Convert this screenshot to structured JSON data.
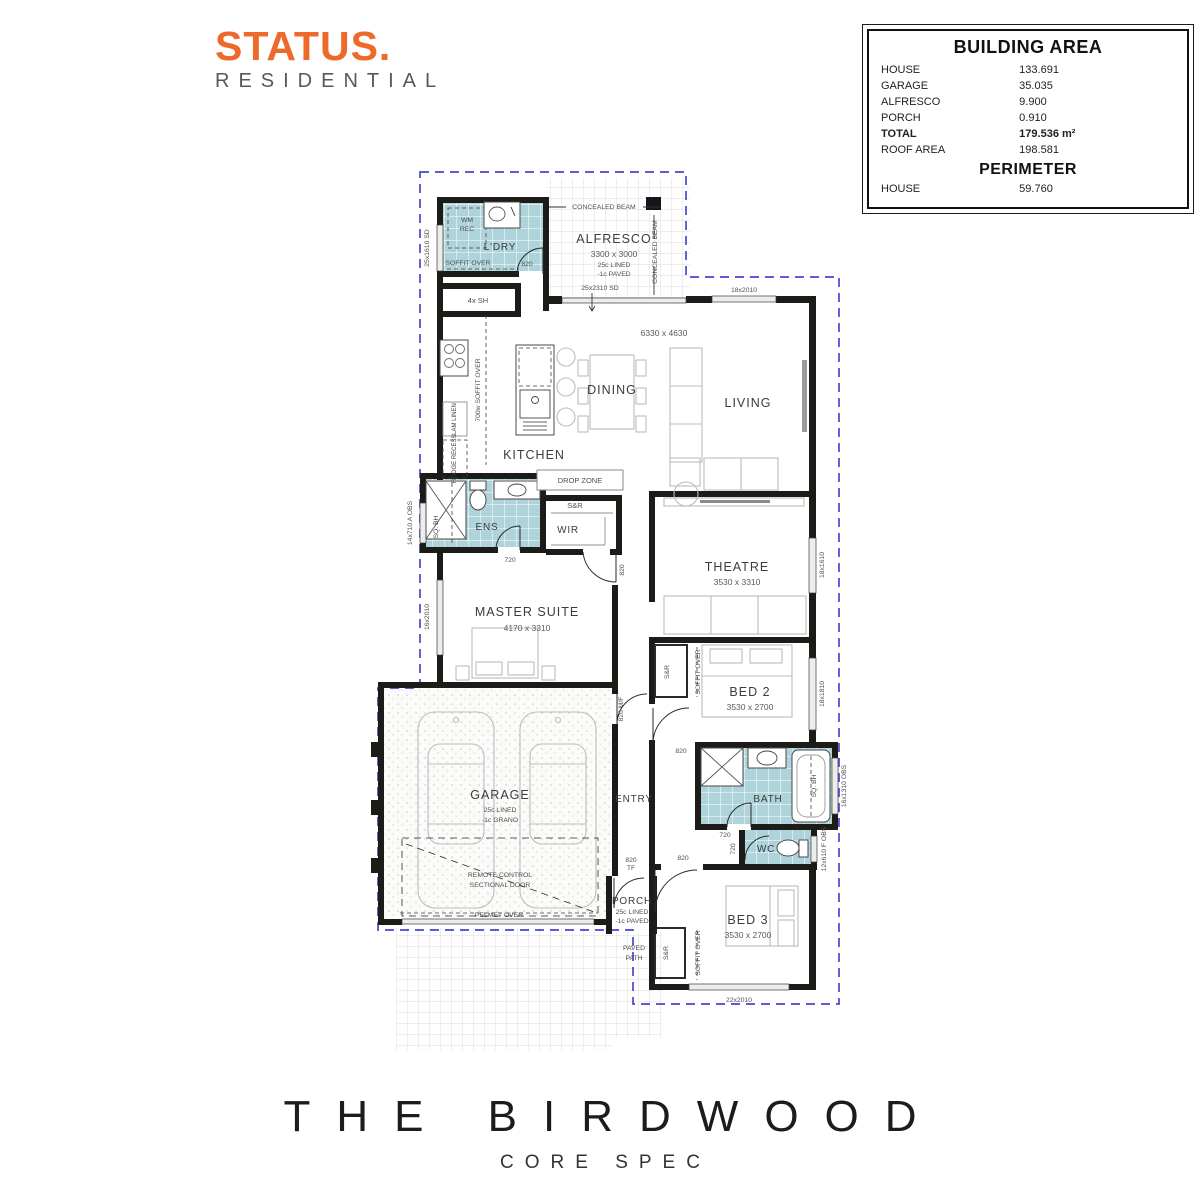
{
  "logo": {
    "brand": "STATUS.",
    "sub": "RESIDENTIAL"
  },
  "area_table": {
    "title": "BUILDING AREA",
    "rows": [
      {
        "label": "HOUSE",
        "value": "133.691"
      },
      {
        "label": "GARAGE",
        "value": "35.035"
      },
      {
        "label": "ALFRESCO",
        "value": "9.900"
      },
      {
        "label": "PORCH",
        "value": "0.910"
      },
      {
        "label": "TOTAL",
        "value": "179.536 m²"
      },
      {
        "label": "ROOF AREA",
        "value": "198.581"
      }
    ],
    "perimeter_title": "PERIMETER",
    "perimeter_rows": [
      {
        "label": "HOUSE",
        "value": "59.760"
      }
    ]
  },
  "footer": {
    "title": "THE BIRDWOOD",
    "subtitle": "CORE SPEC"
  },
  "plan": {
    "labels": {
      "ldry": "L'DRY",
      "shelf_4x": "4x SH",
      "wm_rec": [
        "WM",
        "REC"
      ],
      "alfresco": "ALFRESCO",
      "alfresco_dim": "3300 x 3000",
      "alfresco_spec1": "25c LINED",
      "alfresco_spec2": "-1c PAVED",
      "concealed_beam": "CONCEALED BEAM",
      "kitchen": "KITCHEN",
      "dining": "DINING",
      "living": "LIVING",
      "living_dim": "6330 x 4630",
      "drop_zone": "DROP ZONE",
      "sr": "S&R",
      "wir": "WIR",
      "ens": "ENS",
      "sq_bh": "SQ. BH",
      "master": "MASTER SUITE",
      "master_dim": "4170 x 3310",
      "theatre": "THEATRE",
      "theatre_dim": "3530 x 3310",
      "bed2": "BED 2",
      "bed2_dim": "3530 x 2700",
      "bed3": "BED 3",
      "bed3_dim": "3530 x 2700",
      "garage": "GARAGE",
      "garage_spec1": "25c LINED",
      "garage_spec2": "-1c GRANO",
      "entry": "ENTRY",
      "bath": "BATH",
      "wc": "WC",
      "porch": "PORCH",
      "porch_spec1": "25c LINED",
      "porch_spec2": "-1c PAVED",
      "paved_path": [
        "PAVED",
        "PATH"
      ],
      "remote": [
        "REMOTE CONTROL",
        "SECTIONAL DOOR"
      ],
      "pelmet": "PELMET OVER",
      "soffit_over": "SOFFIT OVER",
      "soffit_700": "700w SOFFIT OVER",
      "lam_linen": "LAM LINEN",
      "fridge_recess": "FRIDGE RECESS"
    },
    "windows": {
      "w25x1610": "25x1610 SD",
      "w25x2310": "25x2310 SD",
      "w18x2010": "18x2010",
      "w18x1610": "18x1610",
      "w18x1810": "18x1810",
      "w16x1310": "16x1310 OBS",
      "w12x610": "12x610 F OBS",
      "w22x2010": "22x2010",
      "w16x2010": "16x2010",
      "w14x710": "14x710 A OBS"
    },
    "doors": {
      "d820": "820",
      "d720": "720",
      "d820_mf": "820 M/F",
      "d820_tf": [
        "820",
        "TF"
      ]
    },
    "colors": {
      "wet_area": "#aed3da",
      "roof_dash": "#4646d2",
      "wall": "#1c1b18",
      "accent_orange": "#ee6a2a"
    }
  }
}
